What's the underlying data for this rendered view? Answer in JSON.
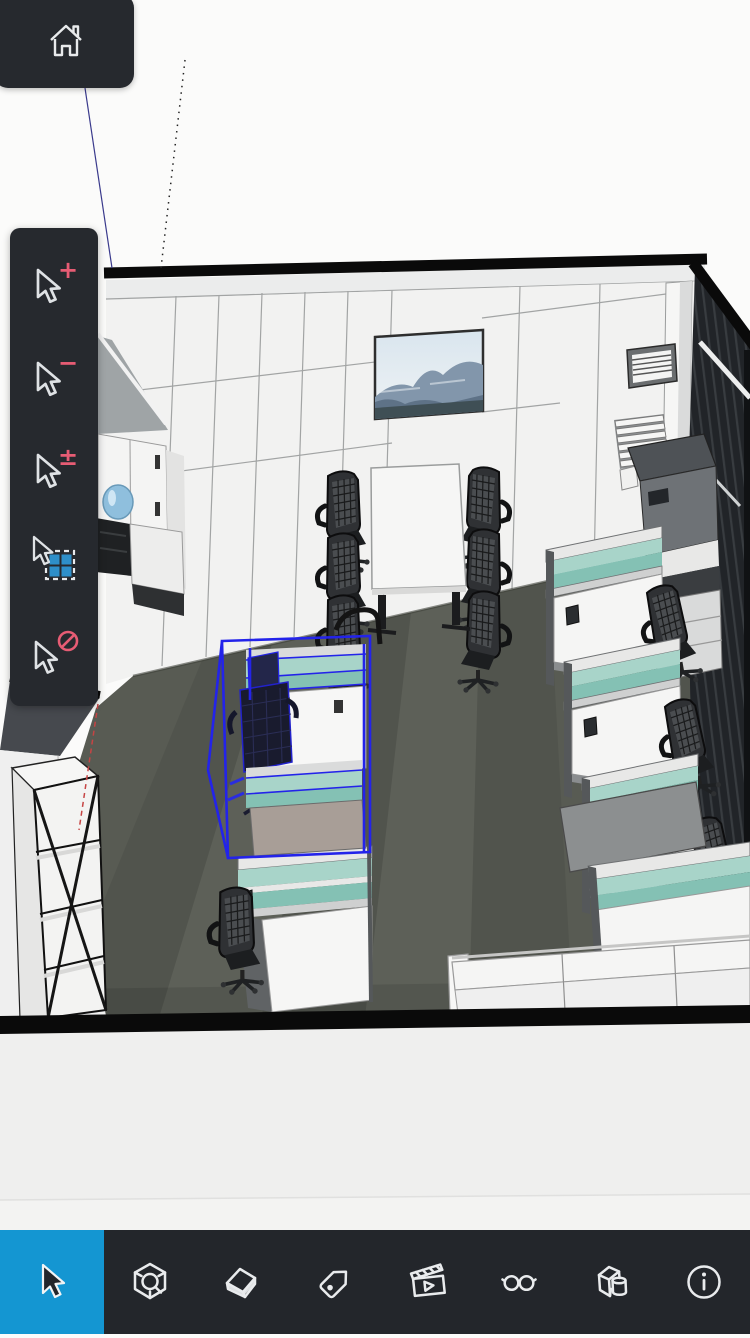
{
  "home_button": {
    "icon": "home-icon"
  },
  "selection_flyout": {
    "items": [
      {
        "id": "select-add",
        "icon": "cursor-plus-icon",
        "modifier": "+"
      },
      {
        "id": "select-subtract",
        "icon": "cursor-minus-icon",
        "modifier": "−"
      },
      {
        "id": "select-add-subtract",
        "icon": "cursor-plus-minus-icon",
        "modifier": "±"
      },
      {
        "id": "select-box",
        "icon": "cursor-marquee-icon",
        "modifier": ""
      },
      {
        "id": "select-none",
        "icon": "cursor-none-icon",
        "modifier": ""
      }
    ]
  },
  "toolbar": {
    "items": [
      {
        "id": "select-tool",
        "icon": "select-cursor-icon",
        "active": true
      },
      {
        "id": "zoom-model-tool",
        "icon": "cube-magnifier-icon",
        "active": false
      },
      {
        "id": "eraser-tool",
        "icon": "eraser-icon",
        "active": false
      },
      {
        "id": "tags-tool",
        "icon": "tag-icon",
        "active": false
      },
      {
        "id": "scenes-tool",
        "icon": "clapperboard-play-icon",
        "active": false
      },
      {
        "id": "ar-view-tool",
        "icon": "glasses-icon",
        "active": false
      },
      {
        "id": "components-tool",
        "icon": "box-cylinder-icon",
        "active": false
      },
      {
        "id": "info-tool",
        "icon": "info-circle-icon",
        "active": false
      }
    ]
  },
  "viewport": {
    "description": "3D office interior model, one desk cubicle selected with blue bounding box"
  },
  "colors": {
    "toolbar-bg": "#23262B",
    "panel-bg": "#26292E",
    "active-blue": "#1496D2",
    "icon-white": "#E9EBED",
    "accent-pink": "#E75C74",
    "marquee-blue": "#2E8FC9",
    "selection-blue": "#2323EA",
    "teal-light": "#A8D4C9",
    "teal-mid": "#84C1B4",
    "floor": "#585B53",
    "wall-white": "#F2F2F1",
    "wall-line": "#A2A4A4",
    "section-black": "#0A0A0A",
    "dark-wall": "#212428",
    "outside-floor": "#EFEFEE"
  }
}
